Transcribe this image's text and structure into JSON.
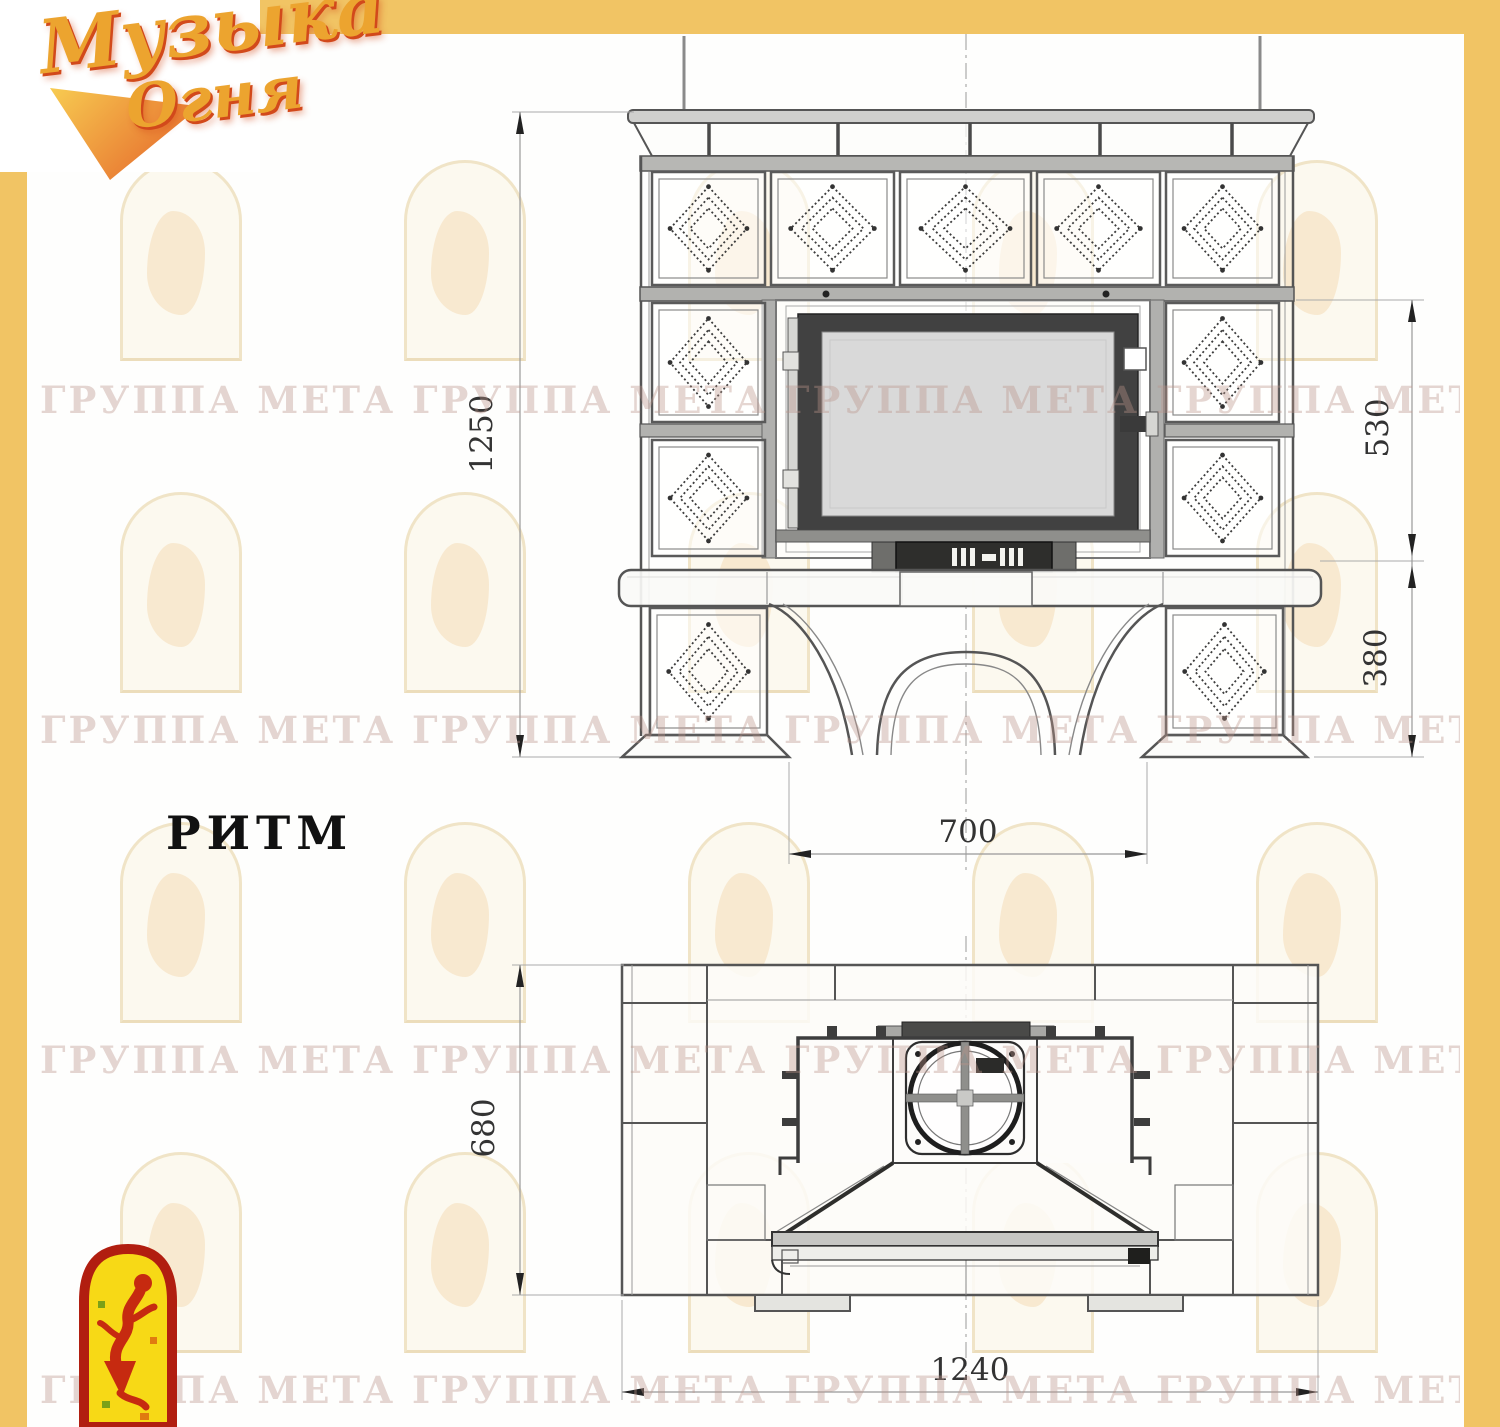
{
  "logo": {
    "word1": "Музыка",
    "word2": "Огня"
  },
  "model_title": "РИТМ",
  "watermark_text": "ГРУППА МЕТА ГРУППА МЕТА ГРУППА МЕТА ГРУППА МЕТА",
  "front_view": {
    "dim_height_mm": "1250",
    "dim_firebox_mm": "530",
    "dim_base_mm": "380",
    "dim_opening_mm": "700"
  },
  "plan_view": {
    "dim_depth_mm": "680",
    "dim_width_mm": "1240"
  },
  "colors": {
    "frame_yellow": "#F1C464",
    "logo_gold": "#ECA42F",
    "logo_red": "#D2491B",
    "emblem_red": "#B11E10",
    "emblem_yellow": "#F7D916"
  }
}
